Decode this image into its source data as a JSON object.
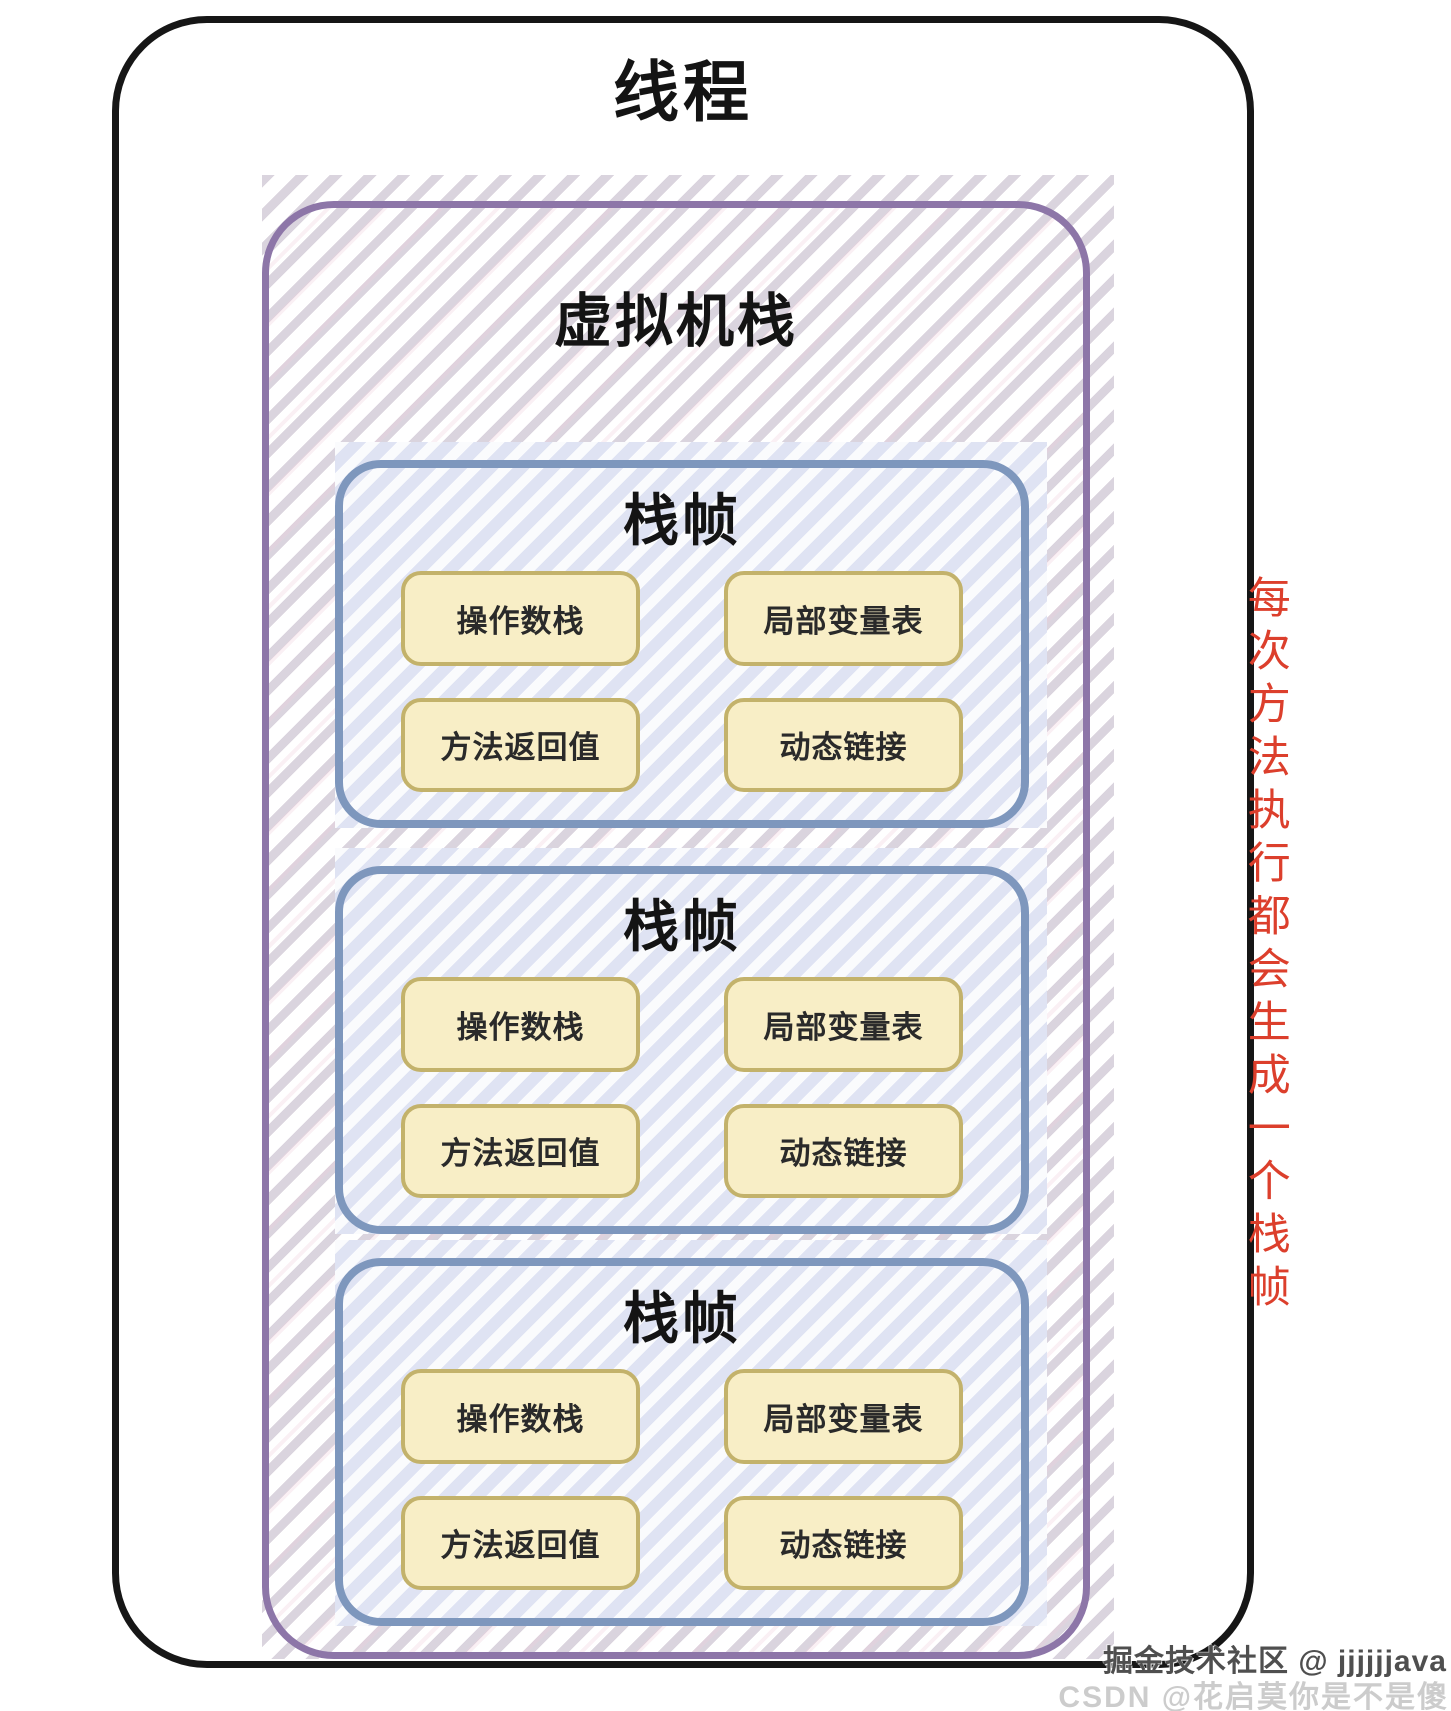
{
  "thread": {
    "title": "线程"
  },
  "vm_stack": {
    "title": "虚拟机栈",
    "frames": [
      {
        "title": "栈帧",
        "cells": {
          "operand_stack": "操作数栈",
          "local_var_table": "局部变量表",
          "return_value": "方法返回值",
          "dynamic_link": "动态链接"
        }
      },
      {
        "title": "栈帧",
        "cells": {
          "operand_stack": "操作数栈",
          "local_var_table": "局部变量表",
          "return_value": "方法返回值",
          "dynamic_link": "动态链接"
        }
      },
      {
        "title": "栈帧",
        "cells": {
          "operand_stack": "操作数栈",
          "local_var_table": "局部变量表",
          "return_value": "方法返回值",
          "dynamic_link": "动态链接"
        }
      }
    ]
  },
  "side_note": {
    "text": "每次方法执行都会生成一个栈帧"
  },
  "watermarks": {
    "juejin": "掘金技术社区 @ jjjjjjava",
    "csdn": "CSDN @花启莫你是不是傻"
  },
  "colors": {
    "thread_border": "#161616",
    "vm_stack_border": "#8d76a8",
    "frame_border": "#7e97bd",
    "cell_fill": "#f8eec6",
    "cell_border": "#c3b26b",
    "side_note_red": "#dc3f2c",
    "watermark_dark": "#4f4f4f",
    "watermark_light": "#cccccc"
  }
}
